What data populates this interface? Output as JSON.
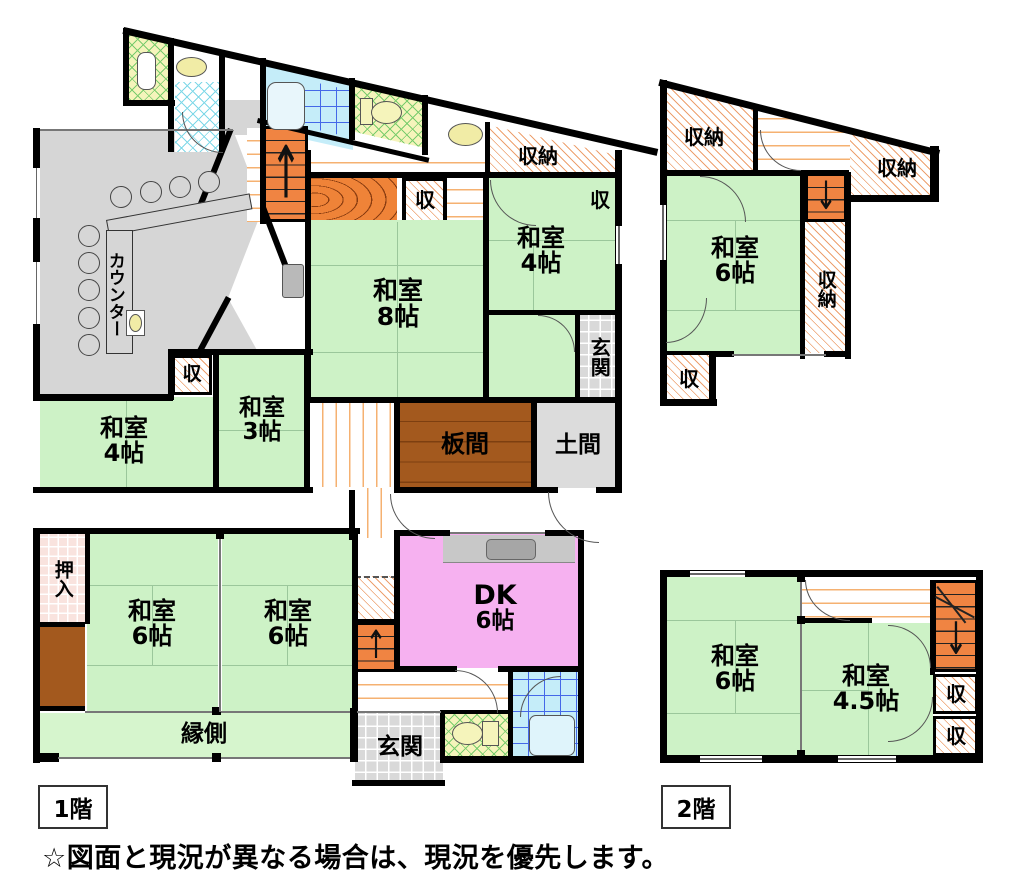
{
  "floor1": {
    "tag": "1階",
    "counter": "カウンター",
    "shu_counter": "収",
    "shu_mid": "収",
    "shu_4r": "収",
    "shuno_top": "収納",
    "washitsu8": {
      "name": "和室",
      "size": "8帖"
    },
    "washitsu4_tr": {
      "name": "和室",
      "size": "4帖"
    },
    "washitsu4_l": {
      "name": "和室",
      "size": "4帖"
    },
    "washitsu3": {
      "name": "和室",
      "size": "3帖"
    },
    "washitsu6_a": {
      "name": "和室",
      "size": "6帖"
    },
    "washitsu6_b": {
      "name": "和室",
      "size": "6帖"
    },
    "dk": {
      "name": "DK",
      "size": "6帖"
    },
    "itanoma": "板間",
    "doma": "土間",
    "genkan_right": "玄関",
    "genkan_main": "玄関",
    "engawa": "縁側",
    "oshiire": "押入"
  },
  "floor2": {
    "tag": "2階",
    "shuno_tl": "収納",
    "shuno_tr": "収納",
    "shuno_right": "収納",
    "shu_bl": "収",
    "washitsu6_up": {
      "name": "和室",
      "size": "6帖"
    },
    "washitsu6_low": {
      "name": "和室",
      "size": "6帖"
    },
    "washitsu45": {
      "name": "和室",
      "size": "4.5帖"
    },
    "shu_r1": "収",
    "shu_r2": "収"
  },
  "stairs": {
    "up_arrow": "↑",
    "down_arrow": "↓"
  },
  "notice": "☆図面と現況が異なる場合は、現況を優先します。",
  "colors": {
    "tatami": "#cdf2c6",
    "dk_pink": "#f6b1f0",
    "stairs_orange": "#f08442",
    "wood_brown": "#a3591e",
    "hatch_line": "#eda06e",
    "floor_gray": "#d6d6d6",
    "bath_tile": "#c5edf9",
    "toilet_floor": "#f5f4bb"
  }
}
